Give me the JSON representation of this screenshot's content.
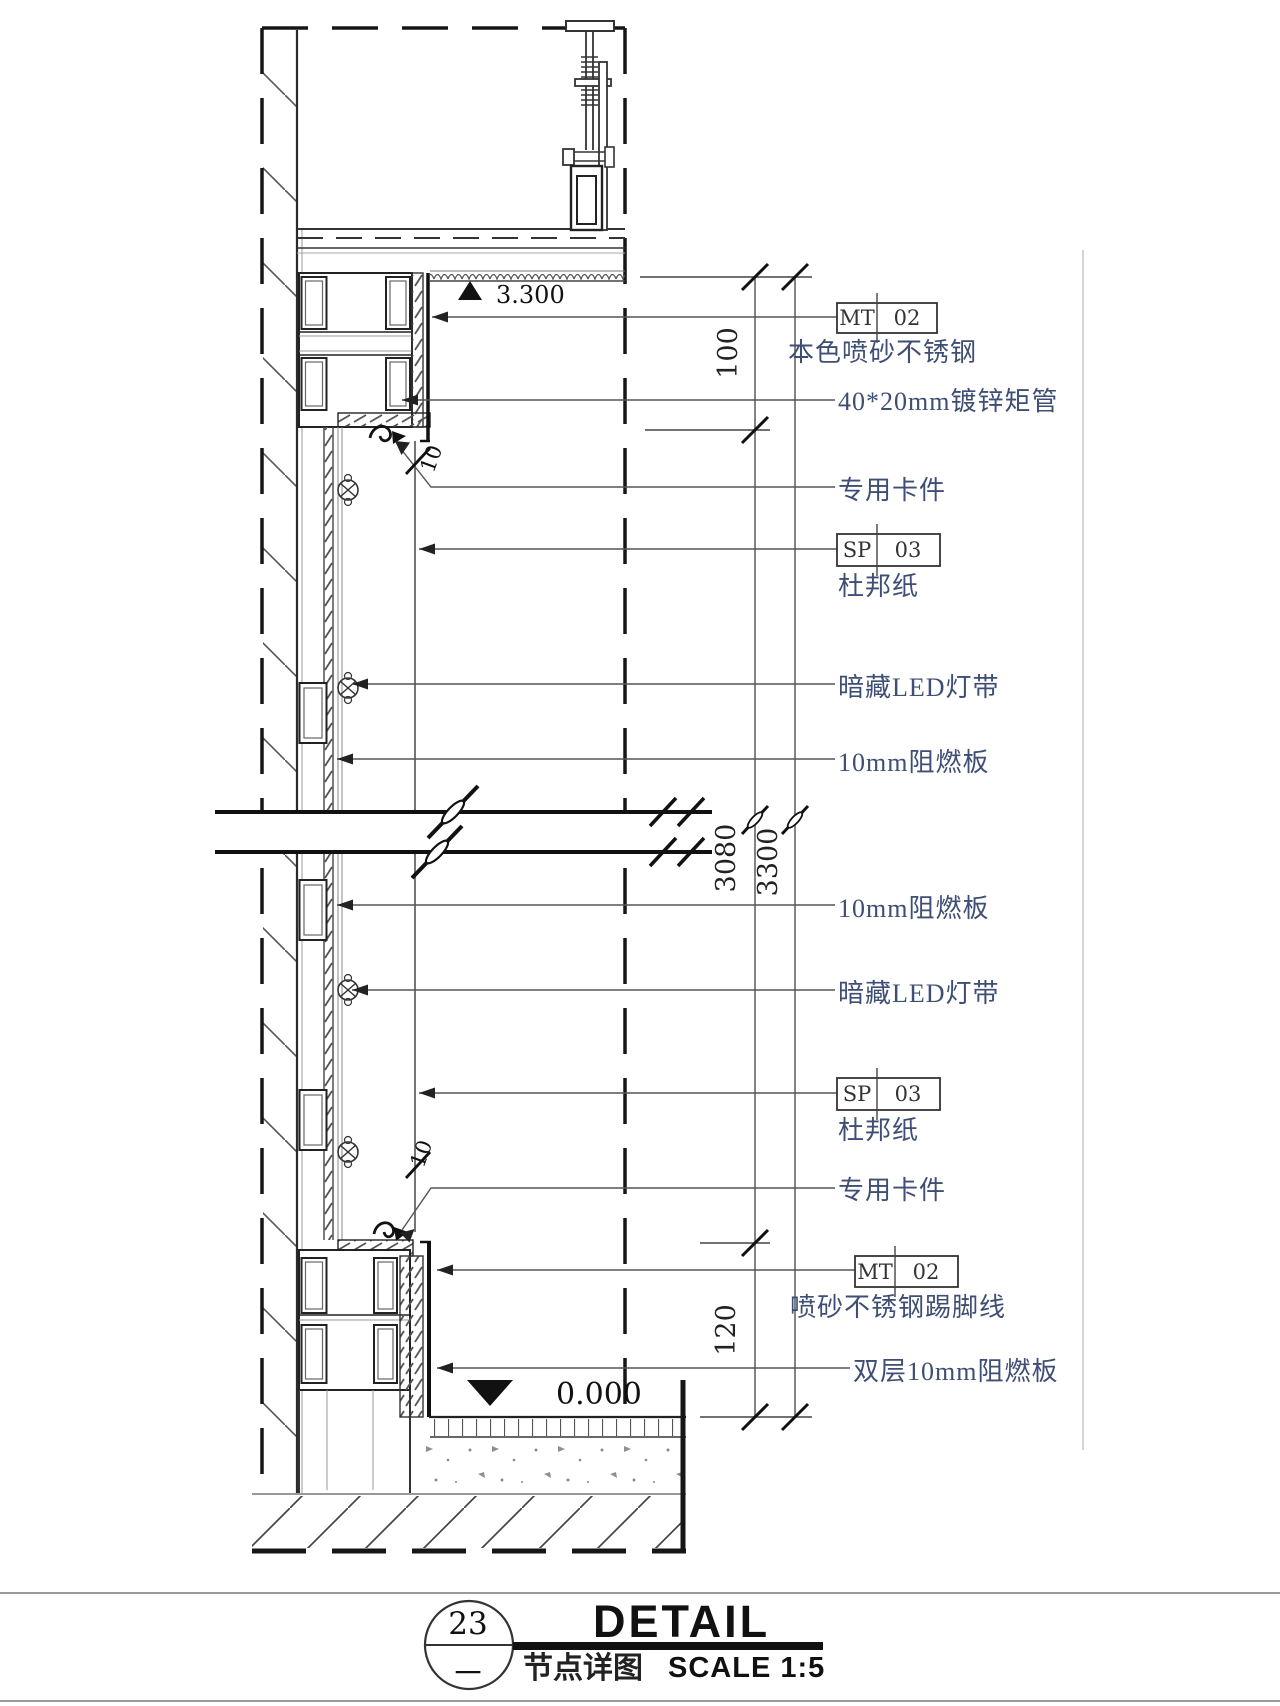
{
  "drawing": {
    "levels": {
      "top": "3.300",
      "bottom": "0.000"
    },
    "dimensions": {
      "d100": "100",
      "d3080": "3080",
      "d3300": "3300",
      "d120": "120",
      "gap_top": "10",
      "gap_bottom": "10"
    },
    "tags": {
      "mt_top": {
        "code": "MT",
        "num": "02"
      },
      "sp_top": {
        "code": "SP",
        "num": "03"
      },
      "sp_bottom": {
        "code": "SP",
        "num": "03"
      },
      "mt_bottom": {
        "code": "MT",
        "num": "02"
      }
    },
    "annotations": {
      "a1": "本色喷砂不锈钢",
      "a2": "40*20mm镀锌矩管",
      "a3": "专用卡件",
      "a4": "杜邦纸",
      "a5": "暗藏LED灯带",
      "a6": "10mm阻燃板",
      "a7": "10mm阻燃板",
      "a8": "暗藏LED灯带",
      "a9": "杜邦纸",
      "a10": "专用卡件",
      "a11": "喷砂不锈钢踢脚线",
      "a12": "双层10mm阻燃板"
    }
  },
  "title_block": {
    "detail_number": "23",
    "sheet_ref": "一",
    "title": "DETAIL",
    "subtitle": "节点详图",
    "scale": "SCALE 1:5"
  }
}
